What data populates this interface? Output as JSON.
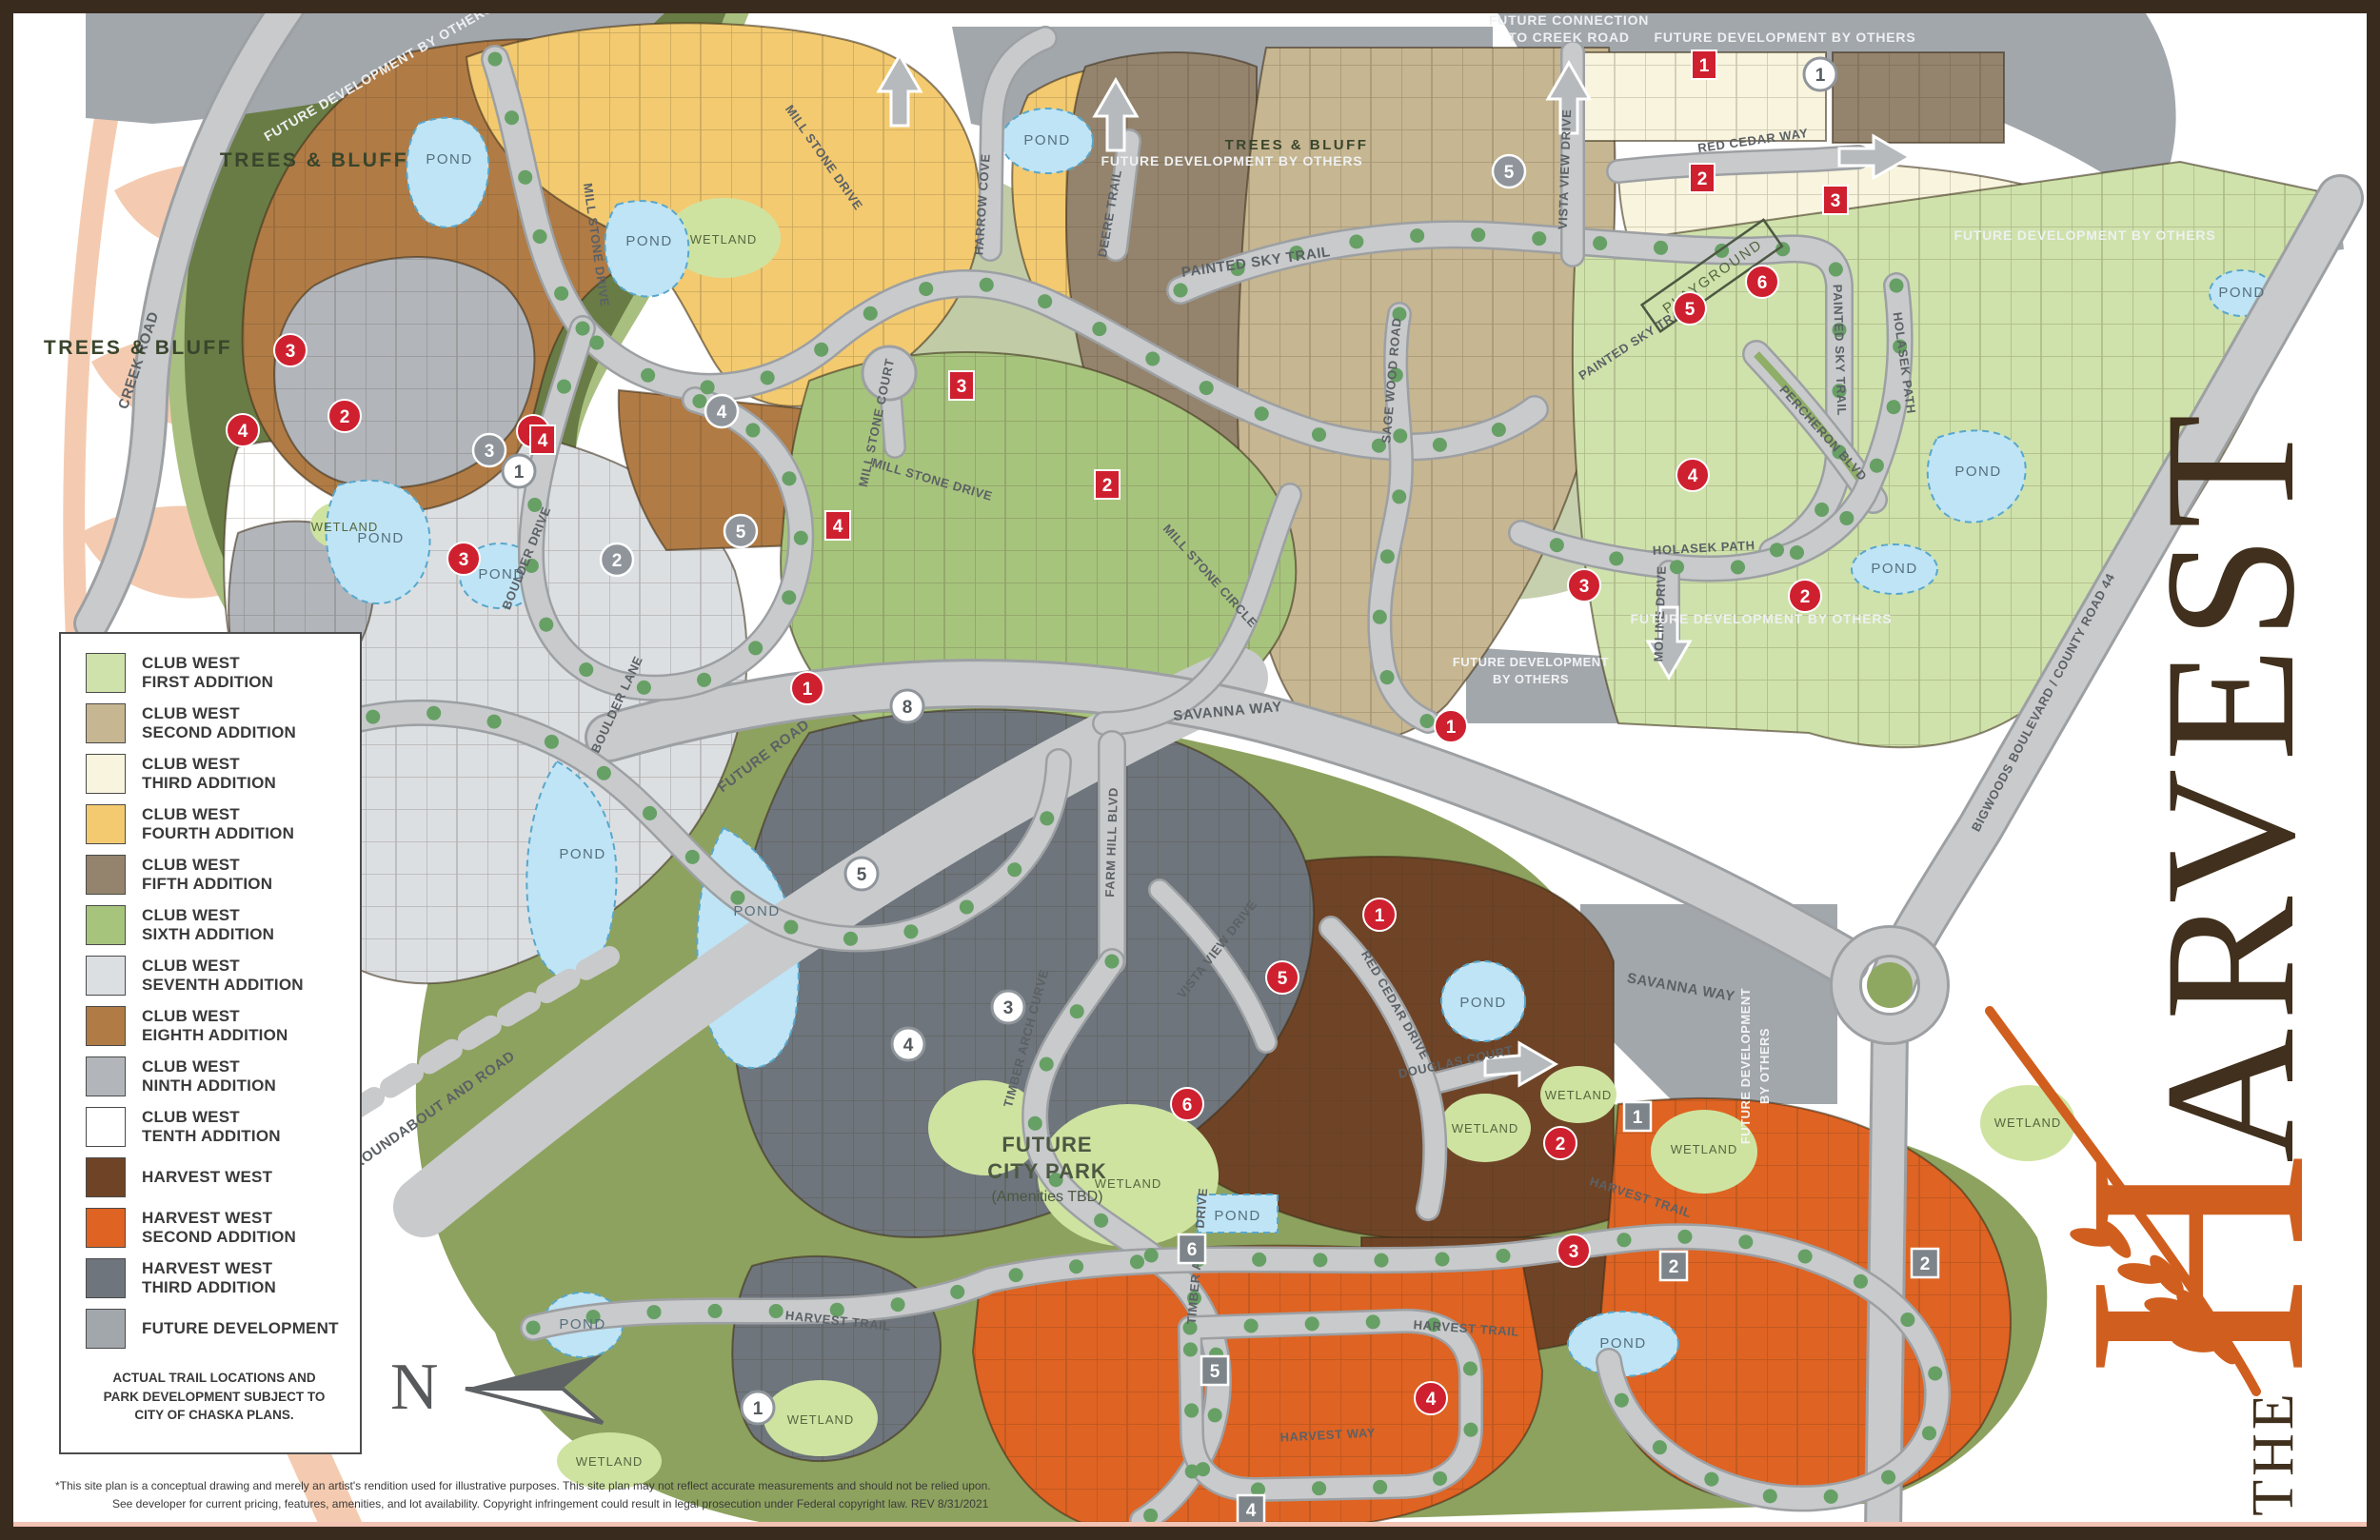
{
  "title": "The Harvest site plan",
  "brand": {
    "the": "THE",
    "h": "H",
    "arvest": "ARVEST",
    "accent_color": "#d05f1f",
    "text_color": "#40301d"
  },
  "legend": {
    "items": [
      {
        "l1": "CLUB WEST",
        "l2": "FIRST ADDITION",
        "color": "#cfe2ab"
      },
      {
        "l1": "CLUB WEST",
        "l2": "SECOND ADDITION",
        "color": "#c6b691"
      },
      {
        "l1": "CLUB WEST",
        "l2": "THIRD ADDITION",
        "color": "#f8f4dd"
      },
      {
        "l1": "CLUB WEST",
        "l2": "FOURTH ADDITION",
        "color": "#f3ca70"
      },
      {
        "l1": "CLUB WEST",
        "l2": "FIFTH ADDITION",
        "color": "#94846d"
      },
      {
        "l1": "CLUB WEST",
        "l2": "SIXTH ADDITION",
        "color": "#a7c47d"
      },
      {
        "l1": "CLUB WEST",
        "l2": "SEVENTH ADDITION",
        "color": "#dcdfe2"
      },
      {
        "l1": "CLUB WEST",
        "l2": "EIGHTH ADDITION",
        "color": "#b07b45"
      },
      {
        "l1": "CLUB WEST",
        "l2": "NINTH ADDITION",
        "color": "#b2b6bb"
      },
      {
        "l1": "CLUB WEST",
        "l2": "TENTH ADDITION",
        "color": "#ffffff"
      },
      {
        "l1": "HARVEST WEST",
        "l2": "",
        "color": "#6f4426"
      },
      {
        "l1": "HARVEST WEST",
        "l2": "SECOND ADDITION",
        "color": "#df6322"
      },
      {
        "l1": "HARVEST WEST",
        "l2": "THIRD ADDITION",
        "color": "#6e757c"
      },
      {
        "l1": "FUTURE DEVELOPMENT",
        "l2": "",
        "color": "#a2a7ac"
      }
    ],
    "note": "ACTUAL TRAIL LOCATIONS AND PARK DEVELOPMENT SUBJECT TO CITY OF CHASKA PLANS."
  },
  "compass": {
    "label": "N"
  },
  "disclaimer": {
    "line1": "*This site plan is a conceptual drawing and merely an artist's rendition used for illustrative purposes.  This site plan may not reflect accurate measurements and should not be relied upon.",
    "line2": "See developer for current pricing, features, amenities, and lot availability. Copyright infringement could result in legal prosecution under Federal copyright law.  REV 8/31/2021"
  },
  "map": {
    "labels": {
      "creek_road": "CREEK ROAD",
      "mill_stone_drive": "MILL STONE DRIVE",
      "mill_stone_court": "MILL STONE COURT",
      "mill_stone_circle": "MILL STONE CIRCLE",
      "boulder_lane": "BOULDER LANE",
      "boulder_drive": "BOULDER DRIVE",
      "harrow_cove": "HARROW COVE",
      "deere_trail": "DEERE TRAIL",
      "painted_sky_trail": "PAINTED SKY TRAIL",
      "vista_view_drive": "VISTA VIEW DRIVE",
      "red_cedar_way": "RED CEDAR WAY",
      "red_cedar_drive": "RED CEDAR DRIVE",
      "sage_wood_road": "SAGE WOOD ROAD",
      "percheron_blvd": "PERCHERON BLVD",
      "holasek_path": "HOLASEK PATH",
      "moline_drive": "MOLINE DRIVE",
      "savanna_way": "SAVANNA WAY",
      "farm_hill_blvd": "FARM HILL BLVD",
      "timber_arch_curve": "TIMBER ARCH CURVE",
      "timber_arch_drive": "TIMBER ARCH DRIVE",
      "douglas_court": "DOUGLAS COURT",
      "harvest_trail": "HARVEST TRAIL",
      "harvest_way": "HARVEST WAY",
      "future_road": "FUTURE ROAD",
      "future_roundabout": "FUTURE ROUNDABOUT AND ROAD",
      "bigwoods": "BIGWOODS BOULEVARD / COUNTY ROAD 44",
      "trees_bluff": "TREES & BLUFF",
      "wetland": "WETLAND",
      "pond": "POND",
      "playground": "PLAYGROUND",
      "future_dev_by_others": "FUTURE DEVELOPMENT BY OTHERS",
      "future_development": "FUTURE DEVELOPMENT",
      "by_others": "BY OTHERS",
      "future_connection_1": "FUTURE CONNECTION",
      "future_connection_2": "TO CREEK ROAD",
      "city_park_1": "FUTURE",
      "city_park_2": "CITY PARK",
      "city_park_3": "(Amenities TBD)"
    },
    "marker_digits": [
      "1",
      "2",
      "3",
      "4",
      "5",
      "6",
      "7",
      "8"
    ]
  }
}
